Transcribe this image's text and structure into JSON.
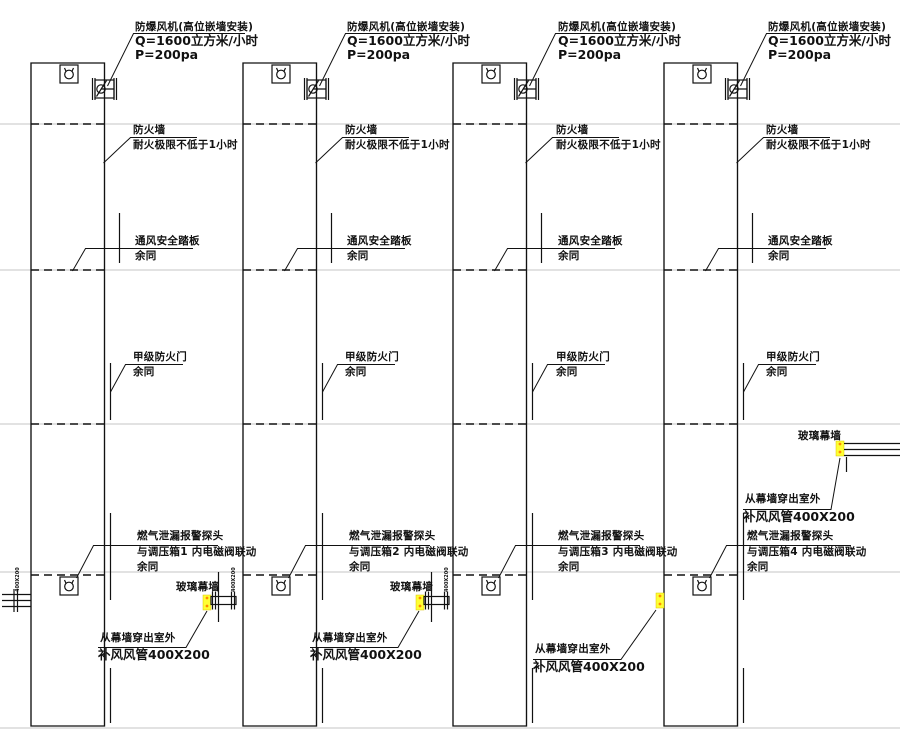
{
  "drawing": {
    "fan_note": {
      "l1": "防爆风机(高位嵌墙安装)",
      "l2": "Q=1600立方米/小时",
      "l3": "P=200pa"
    },
    "firewall_note": {
      "l1": "防火墙",
      "l2": "耐火极限不低于1小时"
    },
    "vent_note": {
      "l1": "通风安全踏板",
      "l2": "余同"
    },
    "door_note": {
      "l1": "甲级防火门",
      "l2": "余同"
    },
    "gas_note": {
      "l1": "燃气泄漏报警探头",
      "l2_by_column": [
        "与调压箱1 内电磁阀联动",
        "与调压箱2 内电磁阀联动",
        "与调压箱3 内电磁阀联动",
        "与调压箱4 内电磁阀联动"
      ],
      "l3": "余同"
    },
    "curtain_label": "玻璃幕墙",
    "out_duct_note": {
      "l1": "从幕墙穿出室外",
      "l2": "补风风管400X200"
    },
    "duct_size_label": "400X200",
    "colors": {
      "line": "#111111",
      "floor_line": "#c6c6c6",
      "highlight": "#ffff33",
      "grip": "#ff8a00"
    }
  }
}
